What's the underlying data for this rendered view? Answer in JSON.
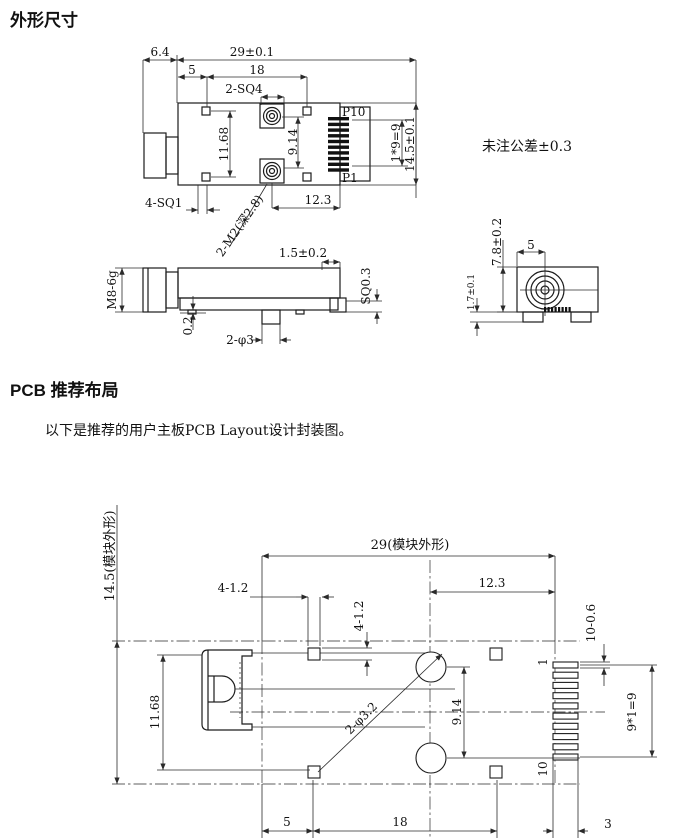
{
  "outline": {
    "title": "外形尺寸",
    "tolerance_note": "未注公差±0.3",
    "top_view": {
      "dim_connector_len": "6.4",
      "dim_width": "29±0.1",
      "dim_sq1_offset": "5",
      "dim_sq1_span": "18",
      "label_posts": "2-SQ4",
      "label_pin_top": "P10",
      "label_pin_bottom": "P1",
      "dim_pin_pitch": "1*9=9",
      "dim_height": "14.5±0.1",
      "dim_sq1_vspan": "11.68",
      "dim_post_span": "9.14",
      "label_corner_pads": "4-SQ1",
      "label_screw_holes": "2-M2(深2.8)",
      "dim_post_offset": "12.3"
    },
    "side_view": {
      "label_thread": "M8-6g",
      "dim_tail": "1.5±0.2",
      "dim_pad_sq": "SQ0.3",
      "dim_standoff": "0.2",
      "label_pins": "2-φ3"
    },
    "end_view": {
      "dim_height": "7.8±0.2",
      "dim_center_offset": "5",
      "dim_foot_height": "1.7±0.1"
    }
  },
  "pcb": {
    "title": "PCB 推荐布局",
    "intro": "以下是推荐的用户主板PCB Layout设计封装图。",
    "dim_module_height": "14.5(模块外形)",
    "dim_module_width": "29(模块外形)",
    "dim_corner_pad_w": "4-1.2",
    "dim_corner_pad_h": "4-1.2",
    "dim_hole_offset": "12.3",
    "dim_pad_size": "10-0.6",
    "label_pad_first": "1",
    "label_pad_last": "10",
    "dim_pad_pitch": "9*1=9",
    "dim_left_vspan": "11.68",
    "dim_hole_span": "9.14",
    "label_holes": "2-φ3.2",
    "dim_bottom_5": "5",
    "dim_bottom_18": "18",
    "dim_bottom_3": "3"
  }
}
